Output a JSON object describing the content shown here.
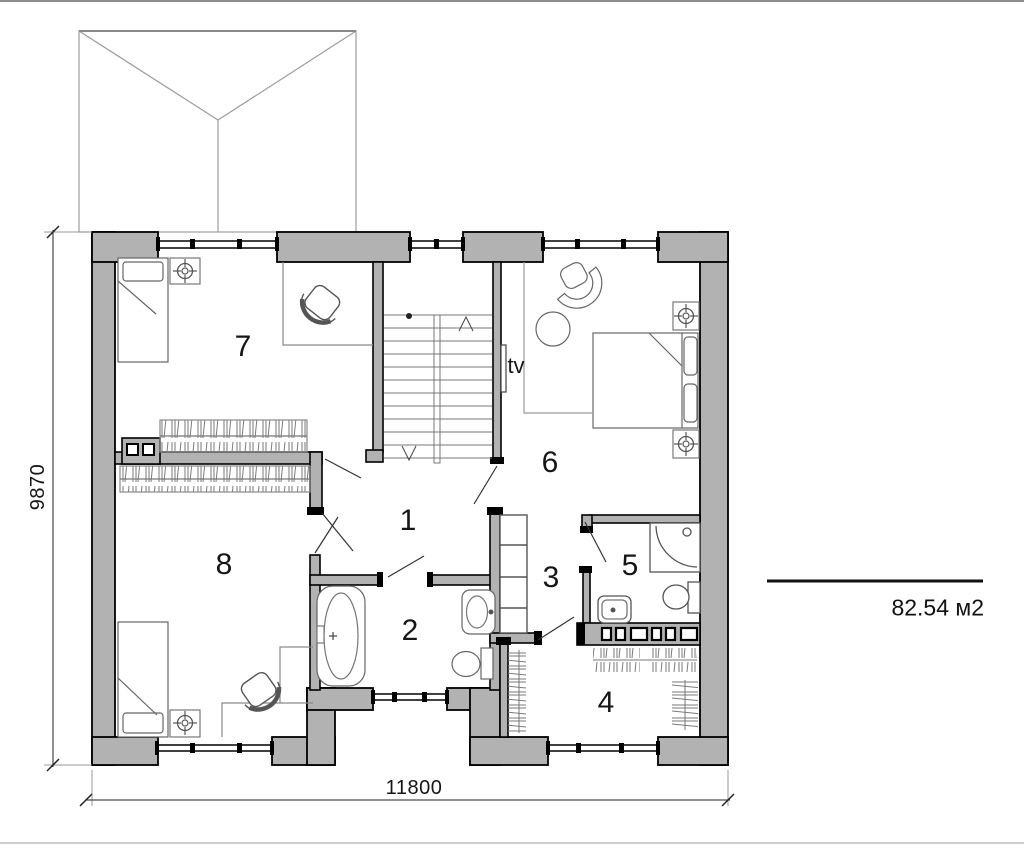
{
  "labels": {
    "room1": "1",
    "room2": "2",
    "room3": "3",
    "room4": "4",
    "room5": "5",
    "room6": "6",
    "room7": "7",
    "room8": "8",
    "tv": "tv"
  },
  "dimensions": {
    "height_mm": "9870",
    "width_mm": "11800",
    "area": "82.54 м2"
  },
  "colors": {
    "wall_fill": "#b2b2b2",
    "outline": "#000000",
    "roof_line": "#9c9c9c",
    "furniture_line": "#666666",
    "dimension_line": "#222222"
  }
}
